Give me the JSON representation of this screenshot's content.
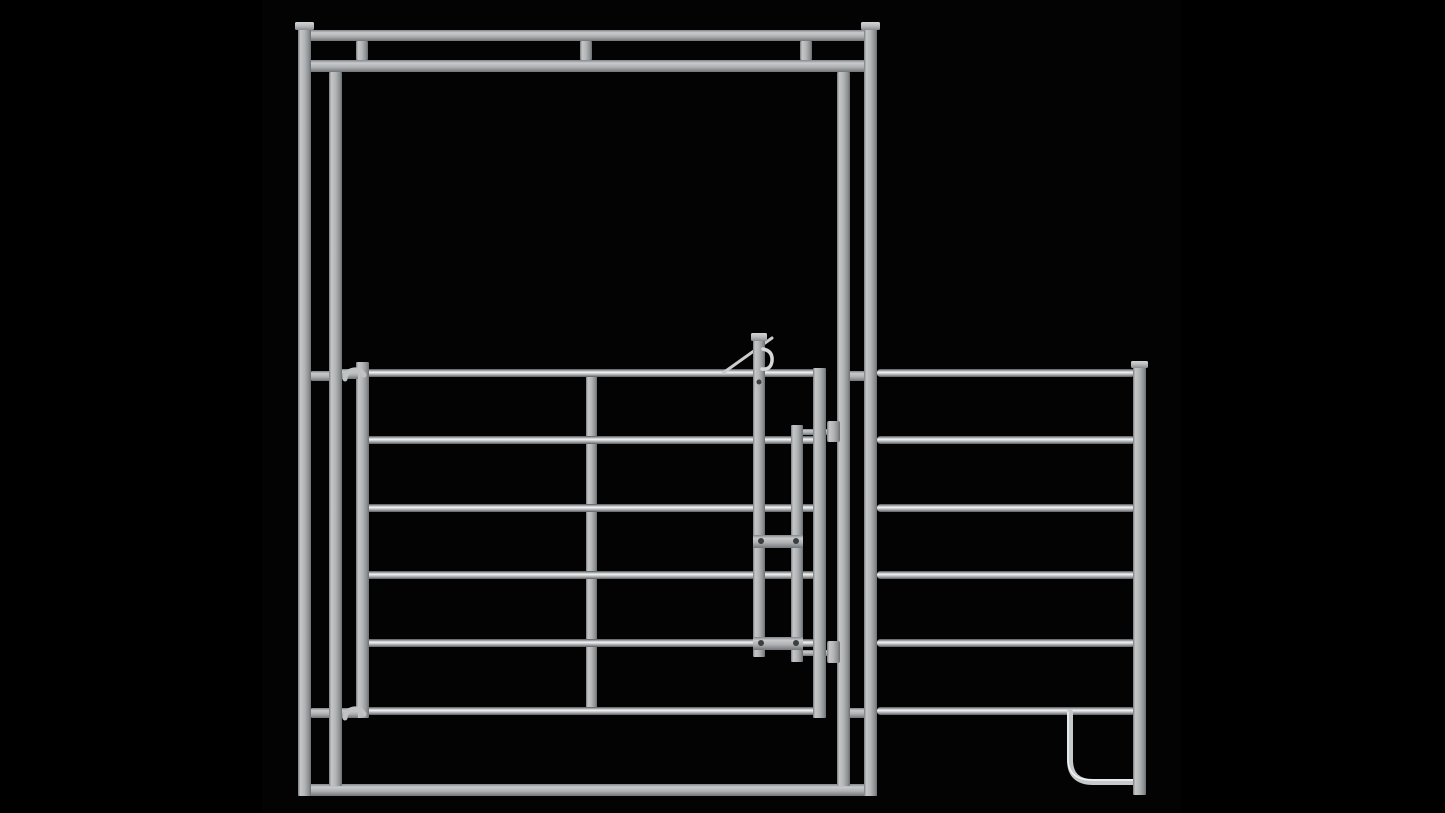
{
  "scene": {
    "subject": "galvanized-steel-bow-gate-frame-with-walkthrough-gate-and-corral-panel",
    "view": "front-orthographic-product-render",
    "canvas": {
      "width": 1445,
      "height": 813
    }
  },
  "colors": {
    "background": "#000000",
    "backdrop": "#030304",
    "bolt": "#3c3f41",
    "tube_mid": "#c6c9cb",
    "tube_highlight": "#f1f3f4",
    "hinge": "#c0c3c5",
    "lever": "#caccce",
    "hook": "#d5d7d9"
  },
  "gradients": [
    {
      "id": "gradRail",
      "dir": "v",
      "stops": [
        [
          0,
          "#54575a"
        ],
        [
          0.15,
          "#909395"
        ],
        [
          0.4,
          "#f2f4f5"
        ],
        [
          0.62,
          "#c2c4c6"
        ],
        [
          1,
          "#5d6063"
        ]
      ]
    },
    {
      "id": "gradPost",
      "dir": "h",
      "stops": [
        [
          0,
          "#7b7e81"
        ],
        [
          0.18,
          "#c4c6c8"
        ],
        [
          0.5,
          "#b3b5b7"
        ],
        [
          0.82,
          "#8e9193"
        ],
        [
          1,
          "#6b6e71"
        ]
      ]
    },
    {
      "id": "gradHBar",
      "dir": "v",
      "stops": [
        [
          0,
          "#83868a"
        ],
        [
          0.25,
          "#c8cacc"
        ],
        [
          0.6,
          "#adafb1"
        ],
        [
          1,
          "#737679"
        ]
      ]
    },
    {
      "id": "gradCap",
      "dir": "v",
      "stops": [
        [
          0,
          "#d3d5d7"
        ],
        [
          0.5,
          "#b7b9bb"
        ],
        [
          1,
          "#898c8e"
        ]
      ]
    }
  ],
  "elements": [
    {
      "name": "render-backdrop",
      "kind": "flat",
      "x": 262,
      "y": 0,
      "w": 919,
      "h": 813,
      "fill": "#030304"
    },
    {
      "name": "header-top-rail",
      "kind": "hbar",
      "x": 300,
      "y": 30,
      "w": 577,
      "h": 11
    },
    {
      "name": "header-lower-rail",
      "kind": "hbar",
      "x": 300,
      "y": 60,
      "w": 577,
      "h": 12
    },
    {
      "name": "header-spacer-left",
      "kind": "vpost",
      "x": 356,
      "y": 41,
      "w": 12,
      "h": 19
    },
    {
      "name": "header-spacer-middle",
      "kind": "vpost",
      "x": 580,
      "y": 41,
      "w": 12,
      "h": 19
    },
    {
      "name": "header-spacer-right",
      "kind": "vpost",
      "x": 800,
      "y": 41,
      "w": 12,
      "h": 19
    },
    {
      "name": "frame-bottom-rail",
      "kind": "hbar",
      "x": 300,
      "y": 784,
      "w": 577,
      "h": 12
    },
    {
      "name": "left-frame-connector-upper",
      "kind": "hbar",
      "x": 311,
      "y": 371,
      "w": 19,
      "h": 10
    },
    {
      "name": "left-frame-connector-lower",
      "kind": "hbar",
      "x": 311,
      "y": 708,
      "w": 19,
      "h": 10
    },
    {
      "name": "right-frame-connector-upper",
      "kind": "hbar",
      "x": 849,
      "y": 371,
      "w": 16,
      "h": 10
    },
    {
      "name": "right-frame-connector-lower",
      "kind": "hbar",
      "x": 849,
      "y": 708,
      "w": 16,
      "h": 10
    },
    {
      "name": "gate-center-brace",
      "kind": "vpost",
      "x": 586,
      "y": 371,
      "w": 11,
      "h": 340
    },
    {
      "name": "gate-rail-1",
      "kind": "rail",
      "x": 363,
      "y": 369,
      "w": 455,
      "h": 8
    },
    {
      "name": "gate-rail-2",
      "kind": "rail",
      "x": 363,
      "y": 436,
      "w": 455,
      "h": 8
    },
    {
      "name": "gate-rail-3",
      "kind": "rail",
      "x": 363,
      "y": 504,
      "w": 455,
      "h": 8
    },
    {
      "name": "gate-rail-4",
      "kind": "rail",
      "x": 363,
      "y": 571,
      "w": 455,
      "h": 8
    },
    {
      "name": "gate-rail-5",
      "kind": "rail",
      "x": 363,
      "y": 639,
      "w": 455,
      "h": 8
    },
    {
      "name": "gate-rail-6",
      "kind": "rail",
      "x": 363,
      "y": 707,
      "w": 455,
      "h": 8
    },
    {
      "name": "panel-rail-1",
      "kind": "rail",
      "x": 877,
      "y": 369,
      "w": 258,
      "h": 8
    },
    {
      "name": "panel-rail-2",
      "kind": "rail",
      "x": 877,
      "y": 436,
      "w": 258,
      "h": 8
    },
    {
      "name": "panel-rail-3",
      "kind": "rail",
      "x": 877,
      "y": 504,
      "w": 258,
      "h": 8
    },
    {
      "name": "panel-rail-4",
      "kind": "rail",
      "x": 877,
      "y": 571,
      "w": 258,
      "h": 8
    },
    {
      "name": "panel-rail-5",
      "kind": "rail",
      "x": 877,
      "y": 639,
      "w": 258,
      "h": 8
    },
    {
      "name": "panel-rail-6",
      "kind": "rail",
      "x": 877,
      "y": 707,
      "w": 258,
      "h": 8
    },
    {
      "name": "panel-hook-tube",
      "kind": "path",
      "d": "M 1070 712 L 1070 760 Q 1070 782 1093 782 L 1134 782",
      "sw": 6,
      "color": "#c6c9cb"
    },
    {
      "name": "panel-hook-highlight",
      "kind": "path",
      "d": "M 1068 712 L 1068 759 Q 1068 780 1092 780 L 1133 780",
      "sw": 1.5,
      "color": "#f1f3f4"
    },
    {
      "name": "panel-end-post",
      "kind": "vpost",
      "x": 1133,
      "y": 364,
      "w": 13,
      "h": 431
    },
    {
      "name": "panel-end-post-cap",
      "kind": "cap",
      "x": 1131,
      "y": 361,
      "w": 17,
      "h": 7
    },
    {
      "name": "latch-pin-upper",
      "kind": "hbar",
      "x": 794,
      "y": 429,
      "w": 34,
      "h": 6
    },
    {
      "name": "latch-pin-lower",
      "kind": "hbar",
      "x": 794,
      "y": 650,
      "w": 34,
      "h": 6
    },
    {
      "name": "gate-hinge-stile",
      "kind": "vpost",
      "x": 356,
      "y": 362,
      "w": 13,
      "h": 356
    },
    {
      "name": "gate-latch-stile",
      "kind": "vpost",
      "x": 813,
      "y": 368,
      "w": 13,
      "h": 350
    },
    {
      "name": "upper-hinge-bracket",
      "kind": "hbar",
      "x": 341,
      "y": 369,
      "w": 17,
      "h": 10
    },
    {
      "name": "upper-hinge-curl",
      "kind": "path",
      "d": "M 345 379 A 10 9 0 0 1 364 375",
      "sw": 5,
      "color": "#c0c3c5"
    },
    {
      "name": "lower-hinge-bracket",
      "kind": "hbar",
      "x": 341,
      "y": 708,
      "w": 17,
      "h": 10
    },
    {
      "name": "lower-hinge-curl",
      "kind": "path",
      "d": "M 345 718 A 10 9 0 0 1 364 714",
      "sw": 5,
      "color": "#c0c3c5"
    },
    {
      "name": "frame-inner-left-post",
      "kind": "vpost",
      "x": 329,
      "y": 72,
      "w": 13,
      "h": 714
    },
    {
      "name": "frame-inner-right-post",
      "kind": "vpost",
      "x": 837,
      "y": 72,
      "w": 13,
      "h": 714
    },
    {
      "name": "frame-outer-left-post",
      "kind": "vpost",
      "x": 298,
      "y": 28,
      "w": 13,
      "h": 768
    },
    {
      "name": "frame-outer-left-post-cap",
      "kind": "cap",
      "x": 295,
      "y": 22,
      "w": 19,
      "h": 8
    },
    {
      "name": "frame-outer-right-post",
      "kind": "vpost",
      "x": 864,
      "y": 28,
      "w": 13,
      "h": 768
    },
    {
      "name": "frame-outer-right-post-cap",
      "kind": "cap",
      "x": 861,
      "y": 22,
      "w": 19,
      "h": 8
    },
    {
      "name": "latch-lever",
      "kind": "path",
      "d": "M 723 373 L 772 338",
      "sw": 3,
      "color": "#caccce"
    },
    {
      "name": "gate-latch-rod",
      "kind": "vpost",
      "x": 753,
      "y": 334,
      "w": 12,
      "h": 323
    },
    {
      "name": "gate-latch-head",
      "kind": "cap",
      "x": 751,
      "y": 333,
      "w": 16,
      "h": 8
    },
    {
      "name": "latch-hook",
      "kind": "path",
      "d": "M 763 349 q 10 2 9 12 q -1 9 -10 8",
      "sw": 3.5,
      "color": "#d5d7d9"
    },
    {
      "name": "latch-rod-bolt",
      "kind": "dot",
      "cx": 759,
      "cy": 382,
      "r": 2.5
    },
    {
      "name": "latch-slide-bar",
      "kind": "vpost",
      "x": 791,
      "y": 425,
      "w": 12,
      "h": 237
    },
    {
      "name": "latch-bracket-upper",
      "kind": "hbar",
      "x": 753,
      "y": 535,
      "w": 50,
      "h": 13
    },
    {
      "name": "latch-bracket-lower",
      "kind": "hbar",
      "x": 753,
      "y": 637,
      "w": 50,
      "h": 13
    },
    {
      "name": "latch-bracket-bolt-1",
      "kind": "dot",
      "cx": 761,
      "cy": 541,
      "r": 3
    },
    {
      "name": "latch-bracket-bolt-2",
      "kind": "dot",
      "cx": 796,
      "cy": 541,
      "r": 3
    },
    {
      "name": "latch-bracket-bolt-3",
      "kind": "dot",
      "cx": 761,
      "cy": 643,
      "r": 3
    },
    {
      "name": "latch-bracket-bolt-4",
      "kind": "dot",
      "cx": 796,
      "cy": 643,
      "r": 3
    },
    {
      "name": "latch-keeper-upper",
      "kind": "block",
      "x": 827,
      "y": 421,
      "w": 13,
      "h": 21
    },
    {
      "name": "latch-keeper-lower",
      "kind": "block",
      "x": 827,
      "y": 641,
      "w": 13,
      "h": 22
    }
  ]
}
